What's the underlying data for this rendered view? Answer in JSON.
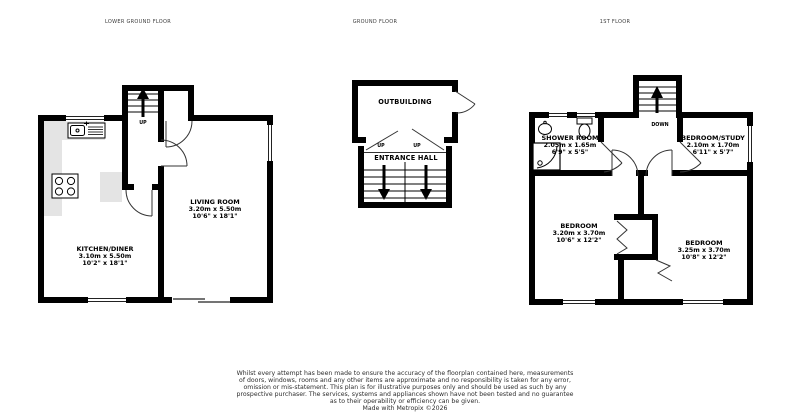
{
  "colors": {
    "wall": "#000000",
    "counter": "#e4e4e4",
    "thin_line": "#1a1a1a",
    "background": "#ffffff"
  },
  "plans": {
    "lower_ground": {
      "title": "LOWER GROUND FLOOR",
      "stairs_label": "UP",
      "rooms": {
        "kitchen_diner": {
          "name": "KITCHEN/DINER",
          "metric": "3.10m x 5.50m",
          "imperial": "10'2\" x 18'1\""
        },
        "living_room": {
          "name": "LIVING ROOM",
          "metric": "3.20m x 5.50m",
          "imperial": "10'6\" x 18'1\""
        }
      }
    },
    "ground": {
      "title": "GROUND FLOOR",
      "stairs_label_left": "UP",
      "stairs_label_right": "UP",
      "rooms": {
        "outbuilding": {
          "name": "OUTBUILDING"
        },
        "entrance_hall": {
          "name": "ENTRANCE HALL"
        }
      }
    },
    "first": {
      "title": "1ST FLOOR",
      "stairs_label": "DOWN",
      "rooms": {
        "shower_room": {
          "name": "SHOWER ROOM",
          "metric": "2.05m x 1.65m",
          "imperial": "6'9\" x 5'5\""
        },
        "bedroom_study": {
          "name": "BEDROOM/STUDY",
          "metric": "2.10m x 1.70m",
          "imperial": "6'11\" x 5'7\""
        },
        "bedroom_left": {
          "name": "BEDROOM",
          "metric": "3.20m x 3.70m",
          "imperial": "10'6\" x 12'2\""
        },
        "bedroom_right": {
          "name": "BEDROOM",
          "metric": "3.25m x 3.70m",
          "imperial": "10'8\" x 12'2\""
        }
      }
    }
  },
  "disclaimer": {
    "lines": [
      "Whilst every attempt has been made to ensure the accuracy of the floorplan contained here, measurements",
      "of doors, windows, rooms and any other items are approximate and no responsibility is taken for any error,",
      "omission or mis-statement. This plan is for illustrative purposes only and should be used as such by any",
      "prospective purchaser. The services, systems and appliances shown have not been tested and no guarantee",
      "as to their operability or efficiency can be given.",
      "Made with Metropix ©2026"
    ]
  }
}
